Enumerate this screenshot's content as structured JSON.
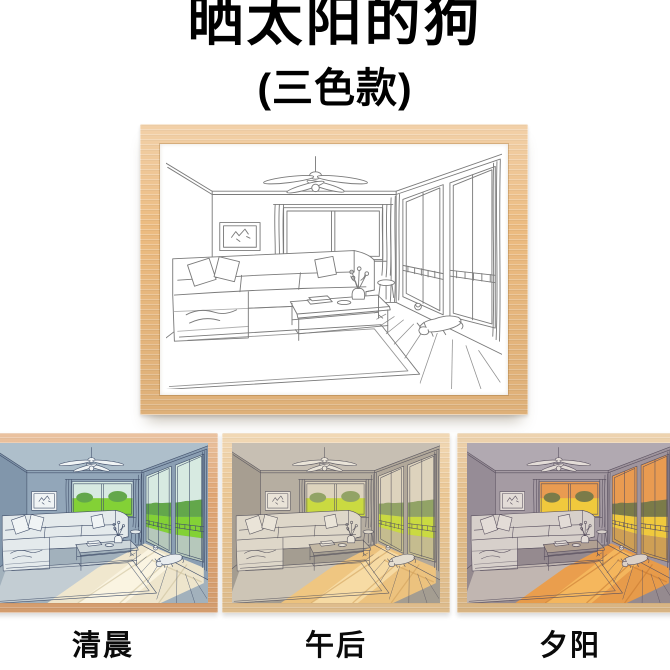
{
  "header": {
    "title": "晒太阳的狗",
    "subtitle": "(三色款)"
  },
  "main_frame": {
    "description": "wooden frame with black-and-white line drawing of a living room with a dog",
    "colors": {
      "wood": "#ecbb80",
      "ink": "#7b7b7b"
    }
  },
  "variants": [
    {
      "id": "morning",
      "label": "清晨",
      "colors": {
        "wood": "#e0a674",
        "ink": "#42506b",
        "ceil": "#aebfcb",
        "wall": "#92a6b9",
        "wallL": "#8196ab",
        "wallR": "#8b9fb3",
        "floor": "#a2b1bc",
        "rug": "#c3cdd3",
        "sofa": "#e4eaec",
        "pillow": "#f0f4f5",
        "tablec": "#cdd6da",
        "dogc": "#e9edef",
        "sky": "#d7eae1",
        "tree": "#63a74b",
        "grass": "#83d136",
        "deck": "#b6c8bb",
        "sun": "#f4e9cd",
        "sun2": "#fdf8e6",
        "sunln": "#cbbd98"
      }
    },
    {
      "id": "afternoon",
      "label": "午后",
      "colors": {
        "wood": "#ebc794",
        "ink": "#5d5a62",
        "ceil": "#c7bfb3",
        "wall": "#b6aea1",
        "wallL": "#a79e91",
        "wallR": "#b1a89a",
        "floor": "#a49d91",
        "rug": "#cdc5b6",
        "sofa": "#ded7c9",
        "pillow": "#eae4d8",
        "tablec": "#c3b8a4",
        "dogc": "#e4ddd0",
        "sky": "#ddd3bd",
        "tree": "#92a366",
        "grass": "#cada41",
        "deck": "#c5bc8f",
        "sun": "#f2c67d",
        "sun2": "#f9e0ac",
        "sunln": "#cf9e58"
      }
    },
    {
      "id": "sunset",
      "label": "夕阳",
      "colors": {
        "wood": "#e5bf8b",
        "ink": "#59505f",
        "ceil": "#b1a9b1",
        "wall": "#a59ba3",
        "wallL": "#968c96",
        "wallR": "#9f949d",
        "floor": "#958a8f",
        "rug": "#c1b6b1",
        "sofa": "#d7d0cb",
        "pillow": "#e3dcd7",
        "tablec": "#b1a092",
        "dogc": "#dcd1c7",
        "sky": "#e99b51",
        "tree": "#7b7b49",
        "grass": "#f0c93d",
        "deck": "#ce9f55",
        "sun": "#ee9c44",
        "sun2": "#f7bd62",
        "sunln": "#c4772f"
      }
    }
  ]
}
